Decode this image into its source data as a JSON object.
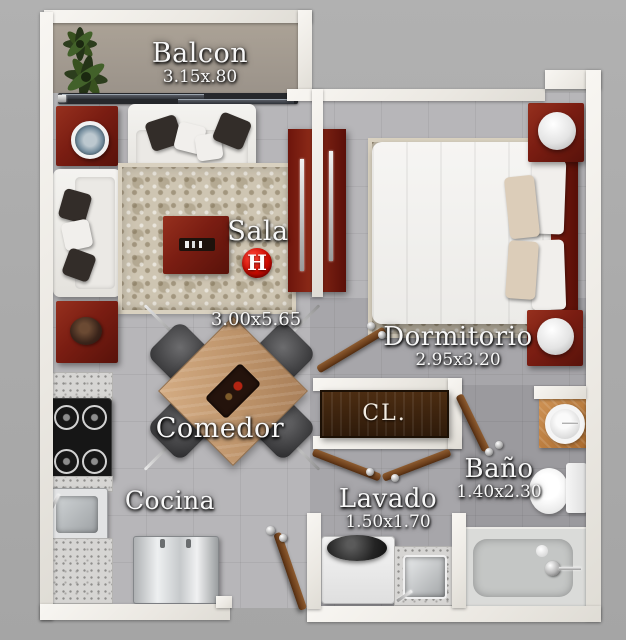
{
  "labels": {
    "balcon": {
      "name": "Balcon",
      "dims": "3.15x.80"
    },
    "sala": {
      "name": "Sala",
      "dims": "3.00x5.65"
    },
    "dormitorio": {
      "name": "Dormitorio",
      "dims": "2.95x3.20"
    },
    "comedor": {
      "name": "Comedor"
    },
    "cocina": {
      "name": "Cocina"
    },
    "lavado": {
      "name": "Lavado",
      "dims": "1.50x1.70"
    },
    "bano": {
      "name": "Baño",
      "dims": "1.40x2.30"
    },
    "closet": {
      "name": "CL."
    }
  },
  "badge": {
    "letter": "H",
    "color": "#cd0b00"
  },
  "colors": {
    "background": "#ababab",
    "wall": "#f2efea",
    "floor": "#b7b6b9",
    "balcony_floor": "#a29a8f",
    "wood_red": "#7a1d12",
    "closet_wood": "#3a2310",
    "rug": "#cec5b2",
    "accent_red": "#cd0b00"
  }
}
